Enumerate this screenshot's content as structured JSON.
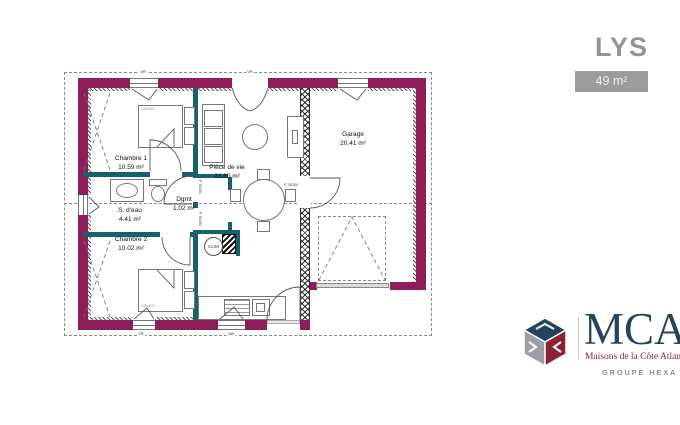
{
  "header": {
    "title": "LYS",
    "area_badge": "49 m²"
  },
  "branding": {
    "logo_text": "MCA",
    "tagline": "Maisons de la Côte Atlantique",
    "group": "GROUPE HEXA",
    "colors": {
      "navy": "#24435e",
      "red": "#8c2133",
      "gray": "#909090"
    }
  },
  "floorplan": {
    "rooms": [
      {
        "name": "Chambre 1",
        "area": "10.59 m²"
      },
      {
        "name": "S. d'eau",
        "area": "4.41 m²"
      },
      {
        "name": "Chambre 2",
        "area": "10.02 m²"
      },
      {
        "name": "Dgmt",
        "area": "1.02 m²"
      },
      {
        "name": "Pièce de vie",
        "area": "23.80 m²"
      },
      {
        "name": "Garage",
        "area": "20.41 m²"
      }
    ],
    "annotations": {
      "clim": "CLIM",
      "door_label": "P 75/204",
      "bed_label": "140x190",
      "shutter_label": "VR",
      "dim_label": "240"
    },
    "colors": {
      "exterior_wall": "#8e1d5a",
      "interior_wall": "#16616a"
    }
  }
}
